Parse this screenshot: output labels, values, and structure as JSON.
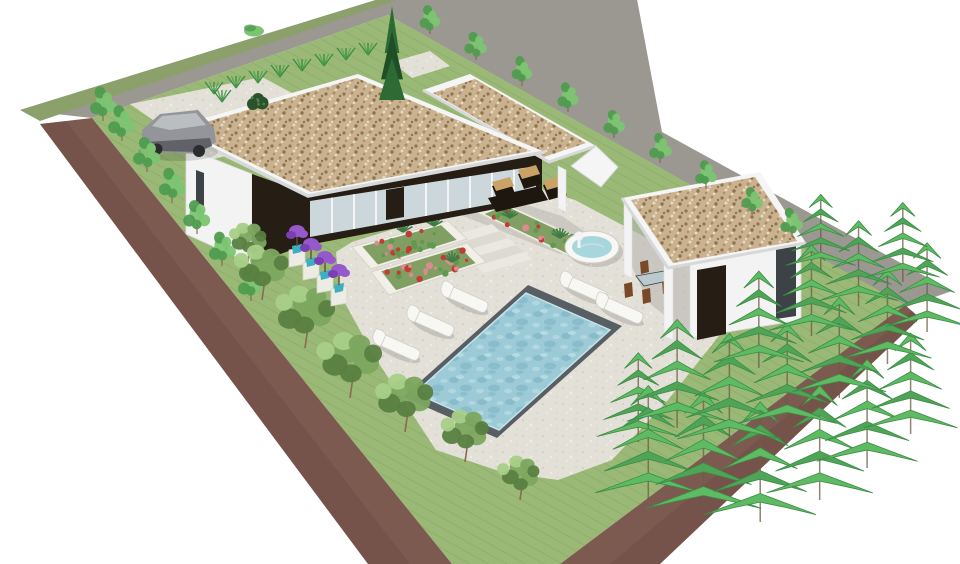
{
  "description": "Axonometric 3D architectural render of a modern single-storey villa: three gravel-topped flat roofs, glass facade, paved terrace, rectangular pool with five white sun loungers, round fountain, flower planters, parked grey car, perimeter road, and dense conifer planting on an elevated green lot with earth banks",
  "palette": {
    "canvas": "#ffffff",
    "road": "#9b9791",
    "road_far_strip": "#8ca06c",
    "grass": "#9ab977",
    "grass_hatch": "#86a663",
    "earth": "#7d5a50",
    "earth_dark": "#664740",
    "paver": "#e3e0d8",
    "paver_speck1": "#ccc8bc",
    "paver_speck2": "#f1efe8",
    "floor_shade": "#b8b6b1",
    "shadow_soft": "rgba(0,0,0,0.13)",
    "fascia": "#f4f5f4",
    "fascia_shade": "#d6d8d9",
    "gravel": "#cab290",
    "gravel_dark": "#8d744f",
    "gravel_mid": "#a98e66",
    "gravel_light": "#e8dcc2",
    "facade_dark": "#261d15",
    "wall_white": "#f2f3f2",
    "wall_shade": "#dddfdf",
    "glass": "#ccd7db",
    "glass_frame": "#f3f4f3",
    "glass_dark": "#3c4245",
    "pool_border": "#575e64",
    "water": "#9ccbd7",
    "water_dark": "#74adbd",
    "water_light": "#c6e4e9",
    "fountain_water": "#a7d7dd",
    "lounger_white": "#f7f7f3",
    "lounger_edge": "#cfcec6",
    "tree_light": "#7cc472",
    "tree_light_dark": "#4f9c4f",
    "tree_olive": "#7ca65f",
    "tree_olive_light": "#a8cf88",
    "tree_olive_dark": "#587f40",
    "cypress": "#2e6b34",
    "cypress_dark": "#1f4f26",
    "pine": "#5fba64",
    "pine_mid": "#4fa458",
    "pine_dark": "#3c8c45",
    "trunk": "#8a6b4f",
    "tuft1": "#58a751",
    "tuft2": "#3a8a41",
    "bush_dark": "#2c522c",
    "bush_light": "#4e7f4c",
    "bed_border": "#f1efe7",
    "bed_soil": "#7a9a5c",
    "bed_leaf": "#5f9b4f",
    "flower_red": "#c23b35",
    "flower_pink": "#dc8b90",
    "flower_purple": "#9659cc",
    "flower_purple_dark": "#7b3fb3",
    "pot_teal": "#3cafc0",
    "pedestal": "#ecebe4",
    "furniture_dark": "#1e1710",
    "cushion": "#c9a366",
    "chair_brown": "#7a4a28",
    "table_glass": "#b9c9cd",
    "car_body": "#93959a",
    "car_body_dark": "#606268",
    "car_window": "#babec1",
    "step_light": "#eae8e1",
    "step_dark": "#dddad2"
  },
  "objects": {
    "buildings": [
      "main house",
      "covered lounge canopy",
      "pool house"
    ],
    "roof_finish": "gravel flat roofs with white fascia",
    "sun_lounger_count": 5,
    "car_count": 1,
    "fountain_count": 1,
    "swimming_pool_count": 1
  },
  "scene": {
    "seed": 7,
    "tufts": [
      [
        214,
        94
      ],
      [
        236,
        88
      ],
      [
        258,
        83
      ],
      [
        280,
        77
      ],
      [
        302,
        71
      ],
      [
        324,
        66
      ],
      [
        346,
        60
      ],
      [
        368,
        55
      ],
      [
        222,
        102
      ]
    ],
    "bushes": [
      [
        258,
        104
      ]
    ],
    "shrubs": [
      [
        254,
        31
      ]
    ],
    "cypress": {
      "x": 392,
      "y": 100,
      "h": 94,
      "w": 26
    },
    "small_trees": [
      [
        430,
        34
      ],
      [
        476,
        60
      ],
      [
        522,
        86
      ],
      [
        568,
        112
      ],
      [
        614,
        138
      ],
      [
        660,
        163
      ],
      [
        706,
        189
      ],
      [
        752,
        215
      ],
      [
        792,
        237
      ]
    ],
    "saplings": [
      [
        103,
        121
      ],
      [
        122,
        141
      ],
      [
        147,
        172
      ],
      [
        172,
        203
      ],
      [
        197,
        234
      ],
      [
        222,
        266
      ],
      [
        251,
        301
      ]
    ],
    "olive_trees": [
      [
        248,
        262,
        1.1
      ],
      [
        262,
        300,
        1.5
      ],
      [
        305,
        348,
        1.7
      ],
      [
        350,
        398,
        1.8
      ],
      [
        405,
        432,
        1.6
      ],
      [
        465,
        462,
        1.4
      ],
      [
        520,
        500,
        1.2
      ]
    ],
    "pines": [
      [
        640,
        442,
        92
      ],
      [
        648,
        500,
        118
      ],
      [
        704,
        516,
        128
      ],
      [
        762,
        522,
        124
      ],
      [
        818,
        500,
        118
      ],
      [
        868,
        468,
        112
      ],
      [
        912,
        434,
        104
      ],
      [
        678,
        428,
        112
      ],
      [
        730,
        446,
        116
      ],
      [
        786,
        430,
        110
      ],
      [
        838,
        398,
        104
      ],
      [
        886,
        364,
        98
      ],
      [
        926,
        332,
        92
      ],
      [
        758,
        368,
        100
      ],
      [
        810,
        336,
        94
      ],
      [
        858,
        306,
        88
      ],
      [
        902,
        282,
        82
      ],
      [
        820,
        270,
        78
      ]
    ],
    "loungers": {
      "angle": 24,
      "positions": [
        [
          398,
          347
        ],
        [
          432,
          323
        ],
        [
          466,
          299
        ],
        [
          585,
          289
        ],
        [
          621,
          310
        ]
      ]
    },
    "purple_pots": [
      [
        297,
        252
      ],
      [
        311,
        265
      ],
      [
        325,
        278
      ],
      [
        339,
        291
      ]
    ],
    "beds": [
      {
        "poly": [
          [
            352,
            247
          ],
          [
            448,
            221
          ],
          [
            467,
            239
          ],
          [
            371,
            269
          ]
        ],
        "colors": [
          "bed_leaf",
          "flower_red",
          "bed_leaf",
          "flower_red",
          "flower_pink",
          "bed_leaf"
        ],
        "n": 24,
        "agaves": [
          [
            403,
            232
          ],
          [
            434,
            226
          ]
        ]
      },
      {
        "poly": [
          [
            371,
            272
          ],
          [
            467,
            243
          ],
          [
            486,
            262
          ],
          [
            389,
            295
          ]
        ],
        "colors": [
          "flower_pink",
          "bed_leaf",
          "flower_red",
          "flower_pink",
          "flower_red"
        ],
        "n": 24,
        "agaves": [
          [
            452,
            262
          ]
        ]
      },
      {
        "poly": [
          [
            472,
            210
          ],
          [
            497,
            200
          ],
          [
            612,
            253
          ],
          [
            587,
            265
          ]
        ],
        "colors": [
          "flower_red",
          "bed_leaf",
          "flower_pink",
          "flower_red",
          "bed_leaf"
        ],
        "n": 28,
        "agaves": [
          [
            510,
            218
          ],
          [
            560,
            238
          ]
        ]
      }
    ]
  }
}
